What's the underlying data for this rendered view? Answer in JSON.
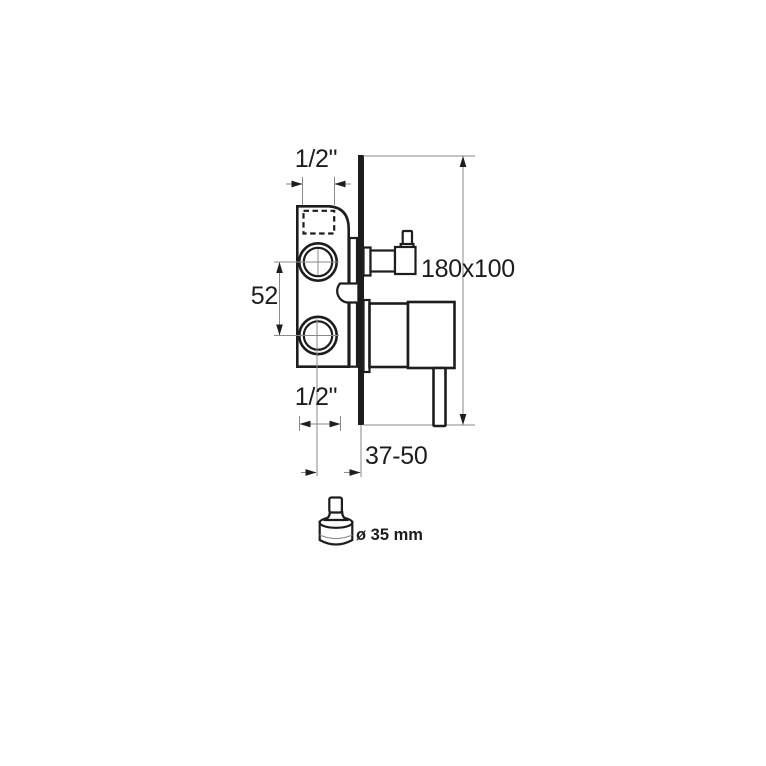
{
  "colors": {
    "ink": "#1d1d1b",
    "dim_line": "#8a8a8a",
    "background": "#ffffff"
  },
  "diagram": {
    "type": "technical-installation-drawing",
    "subject": "concealed shower mixer valve, side section view",
    "labels": {
      "top_port_size": "1/2\"",
      "port_spacing": "52",
      "bottom_port_size": "1/2\"",
      "rough_in_box_size": "180x100",
      "installation_depth_range": "37-50",
      "cartridge_diameter": "ø 35 mm"
    }
  }
}
